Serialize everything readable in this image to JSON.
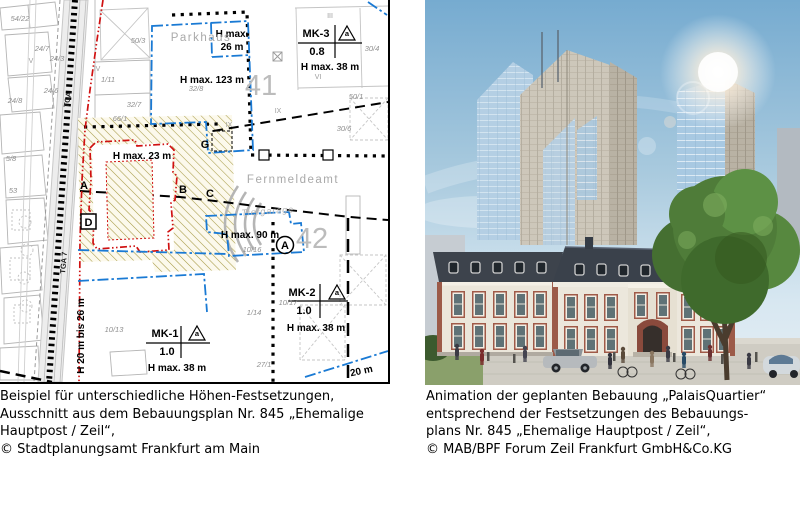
{
  "captions": {
    "left": [
      "Beispiel für unterschiedliche Höhen-Festsetzungen,",
      "Ausschnitt aus dem Bebauungsplan Nr. 845 „Ehemalige",
      "Hauptpost / Zeil“,",
      "© Stadtplanungsamt Frankfurt am Main"
    ],
    "right": [
      "Animation der geplanten Bebauung „PalaisQuartier“",
      "entsprechend der Festsetzungen des Bebauungs-",
      "plans Nr. 845  „Ehemalige Hauptpost / Zeil“,",
      "© MAB/BPF Forum Zeil Frankfurt GmbH&Co.KG"
    ]
  },
  "map": {
    "labels": [
      {
        "t": "H max.",
        "x": 232,
        "y": 37,
        "c": "hmax"
      },
      {
        "t": "26 m",
        "x": 232,
        "y": 50,
        "c": "hmax"
      },
      {
        "t": "H max.  123 m",
        "x": 212,
        "y": 83,
        "c": "hmax"
      },
      {
        "t": "H max.  23 m",
        "x": 142,
        "y": 159,
        "c": "hmax"
      },
      {
        "t": "H max.  90 m",
        "x": 250,
        "y": 238,
        "c": "hmax"
      },
      {
        "t": "MK-3",
        "x": 316,
        "y": 37,
        "c": "mk"
      },
      {
        "t": "0.8",
        "x": 317,
        "y": 55,
        "c": "mk"
      },
      {
        "t": "H max.  38 m",
        "x": 330,
        "y": 70,
        "c": "hmax"
      },
      {
        "t": "a",
        "x": 347,
        "y": 36,
        "c": "tri"
      },
      {
        "t": "MK-2",
        "x": 302,
        "y": 296,
        "c": "mk"
      },
      {
        "t": "1.0",
        "x": 304,
        "y": 314,
        "c": "mk"
      },
      {
        "t": "H max.  38 m",
        "x": 316,
        "y": 331,
        "c": "hmax"
      },
      {
        "t": "a",
        "x": 337,
        "y": 295,
        "c": "tri"
      },
      {
        "t": "MK-1",
        "x": 165,
        "y": 337,
        "c": "mk"
      },
      {
        "t": "1.0",
        "x": 167,
        "y": 355,
        "c": "mk"
      },
      {
        "t": "H max.  38 m",
        "x": 177,
        "y": 371,
        "c": "hmax"
      },
      {
        "t": "a",
        "x": 197,
        "y": 336,
        "c": "tri"
      },
      {
        "t": "Parkhaus",
        "x": 201,
        "y": 41,
        "c": "gray-md"
      },
      {
        "t": "Fernmeldeamt",
        "x": 293,
        "y": 183,
        "c": "gray-md"
      },
      {
        "t": "Tiefgarage",
        "x": 268,
        "y": 214,
        "c": "gray-sm",
        "r": -4
      },
      {
        "t": "41",
        "x": 261,
        "y": 95,
        "c": "gray-lg"
      },
      {
        "t": "42",
        "x": 312,
        "y": 248,
        "c": "gray-lg"
      },
      {
        "t": "A",
        "x": 84,
        "y": 189,
        "c": "marker"
      },
      {
        "t": "B",
        "x": 183,
        "y": 193,
        "c": "marker"
      },
      {
        "t": "C",
        "x": 210,
        "y": 197,
        "c": "marker"
      },
      {
        "t": "D",
        "x": 88.5,
        "y": 226,
        "c": "marker"
      },
      {
        "t": "G",
        "x": 205,
        "y": 148,
        "c": "marker"
      },
      {
        "t": "A",
        "x": 285,
        "y": 249,
        "c": "marker"
      },
      {
        "t": "H 20 m bis 26 m",
        "x": 84,
        "y": 336,
        "c": "hmax",
        "r": -90
      },
      {
        "t": "TGA",
        "x": 70,
        "y": 100,
        "c": "vert-sm",
        "r": -80
      },
      {
        "t": "TGA 7",
        "x": 66,
        "y": 263,
        "c": "vert-sm",
        "r": -85
      },
      {
        "t": "20 m",
        "x": 362,
        "y": 374,
        "c": "hmax",
        "r": -12
      },
      {
        "t": "54/22",
        "x": 20,
        "y": 21,
        "c": "parcel"
      },
      {
        "t": "24/7",
        "x": 42,
        "y": 51,
        "c": "parcel"
      },
      {
        "t": "24/3",
        "x": 57,
        "y": 61,
        "c": "parcel"
      },
      {
        "t": "24/6",
        "x": 51,
        "y": 93,
        "c": "parcel"
      },
      {
        "t": "24/8",
        "x": 15,
        "y": 103,
        "c": "parcel"
      },
      {
        "t": "50/3",
        "x": 138,
        "y": 43,
        "c": "parcel"
      },
      {
        "t": "1/11",
        "x": 108,
        "y": 82,
        "c": "parcel"
      },
      {
        "t": "32/7",
        "x": 134,
        "y": 107,
        "c": "parcel"
      },
      {
        "t": "66/1",
        "x": 120,
        "y": 121,
        "c": "parcel"
      },
      {
        "t": "32/8",
        "x": 196,
        "y": 91,
        "c": "parcel"
      },
      {
        "t": "30/4",
        "x": 372,
        "y": 51,
        "c": "parcel"
      },
      {
        "t": "50/1",
        "x": 356,
        "y": 99,
        "c": "parcel"
      },
      {
        "t": "30/6",
        "x": 344,
        "y": 131,
        "c": "parcel"
      },
      {
        "t": "10/16",
        "x": 252,
        "y": 252,
        "c": "parcel"
      },
      {
        "t": "10/13",
        "x": 114,
        "y": 332,
        "c": "parcel"
      },
      {
        "t": "1/14",
        "x": 254,
        "y": 315,
        "c": "parcel"
      },
      {
        "t": "27/1",
        "x": 264,
        "y": 367,
        "c": "parcel"
      },
      {
        "t": "10/17",
        "x": 288,
        "y": 305,
        "c": "parcel"
      },
      {
        "t": "5/8",
        "x": 11,
        "y": 161,
        "c": "parcel"
      },
      {
        "t": "53",
        "x": 13,
        "y": 193,
        "c": "parcel"
      },
      {
        "t": "III",
        "x": 330,
        "y": 18,
        "c": "roman"
      },
      {
        "t": "IV",
        "x": 97,
        "y": 71,
        "c": "roman"
      },
      {
        "t": "VI",
        "x": 318,
        "y": 79,
        "c": "roman"
      },
      {
        "t": "IX",
        "x": 278,
        "y": 113,
        "c": "roman"
      },
      {
        "t": "V",
        "x": 31,
        "y": 63,
        "c": "roman"
      },
      {
        "t": "IX",
        "x": 229,
        "y": 127,
        "c": "roman"
      }
    ]
  },
  "colors": {
    "map_red": "#d01010",
    "map_blue": "#1a7ad4",
    "hatch_olive": "#a79a45",
    "sky_top": "#76abd0",
    "roof_slate": "#3a414b",
    "palace_red": "#9a5a48"
  }
}
